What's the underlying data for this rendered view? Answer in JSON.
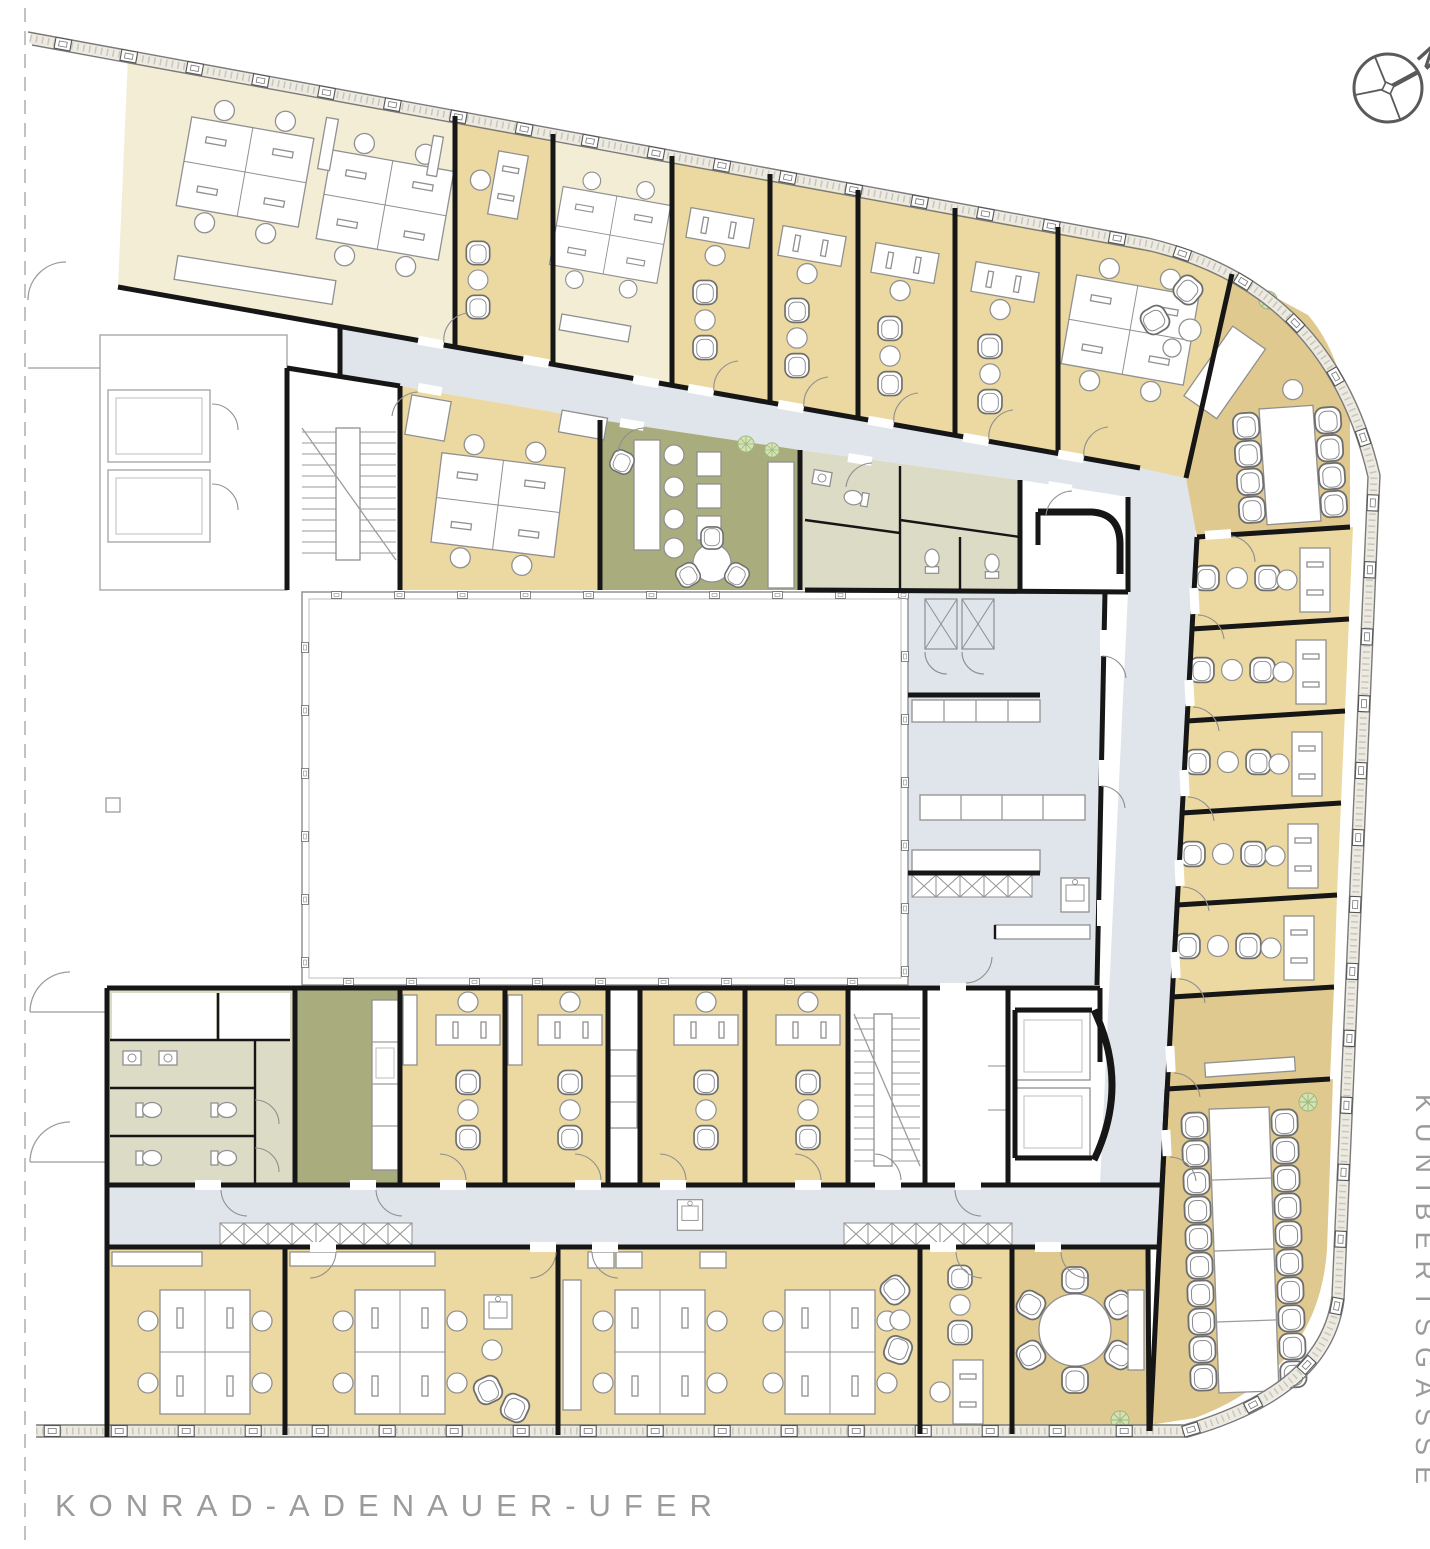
{
  "streets": {
    "bottom": "KONRAD-ADENAUER-UFER",
    "right": "KUNIBERTSGASSE"
  },
  "compass": {
    "label": "N"
  },
  "colors": {
    "office_yellow": "#ecd9a1",
    "office_cream": "#f4edd6",
    "office_tan": "#dfc98f",
    "break_green": "#a9ad7d",
    "wc_green": "#dcdcc6",
    "corridor_blue": "#dfe5ea",
    "wall": "#161616",
    "furniture_stroke": "#909090",
    "facade": "#7a7a7a",
    "label_gray": "#9b9b9b",
    "plant_green": "#d4e2b4",
    "courtyard_line": "#9a9a9a"
  }
}
